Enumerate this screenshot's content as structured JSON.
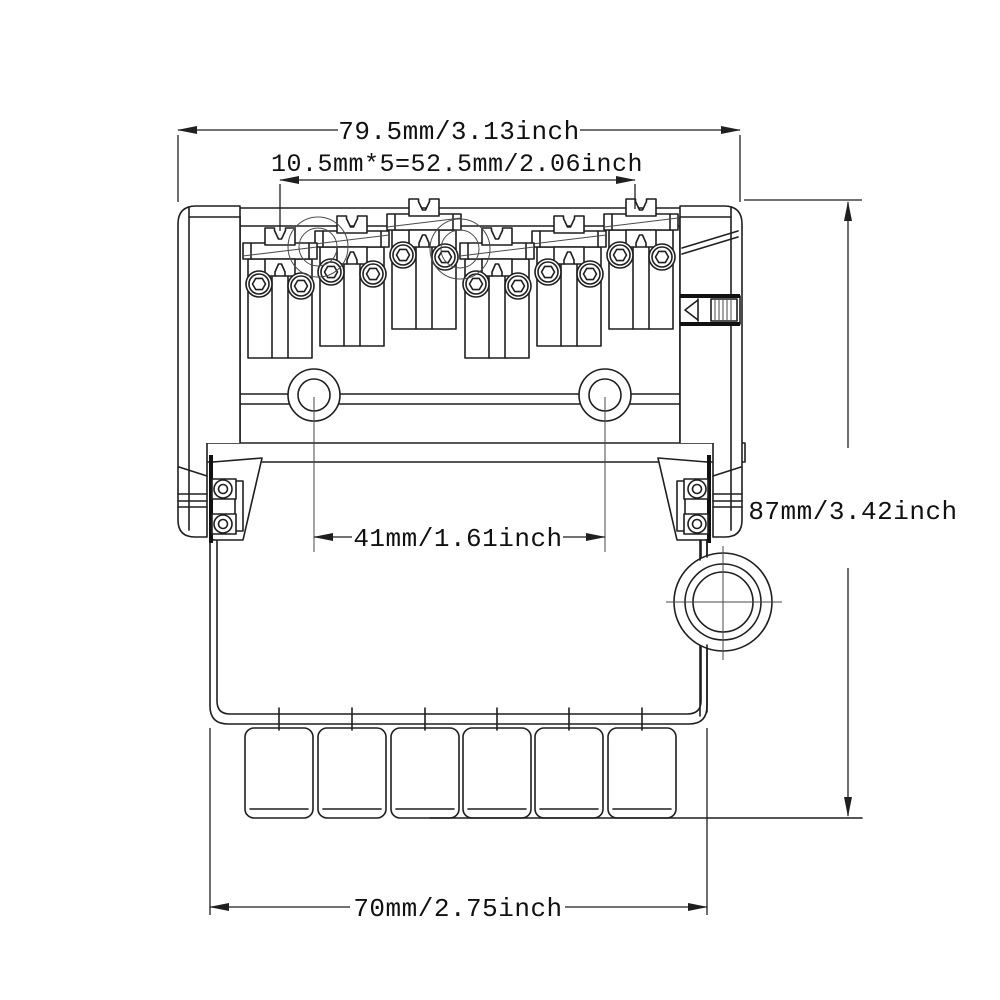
{
  "drawing": {
    "kind": "technical-dimension-drawing",
    "view": "bridge-rear-view"
  },
  "dimensions": {
    "top_width": "79.5mm/3.13inch",
    "string_spacing": "10.5mm*5=52.5mm/2.06inch",
    "height": "87mm/3.42inch",
    "mount_hole_spacing": "41mm/1.61inch",
    "bottom_width": "70mm/2.75inch"
  },
  "colors": {
    "line": "#1f1f1f",
    "background": "#ffffff"
  }
}
